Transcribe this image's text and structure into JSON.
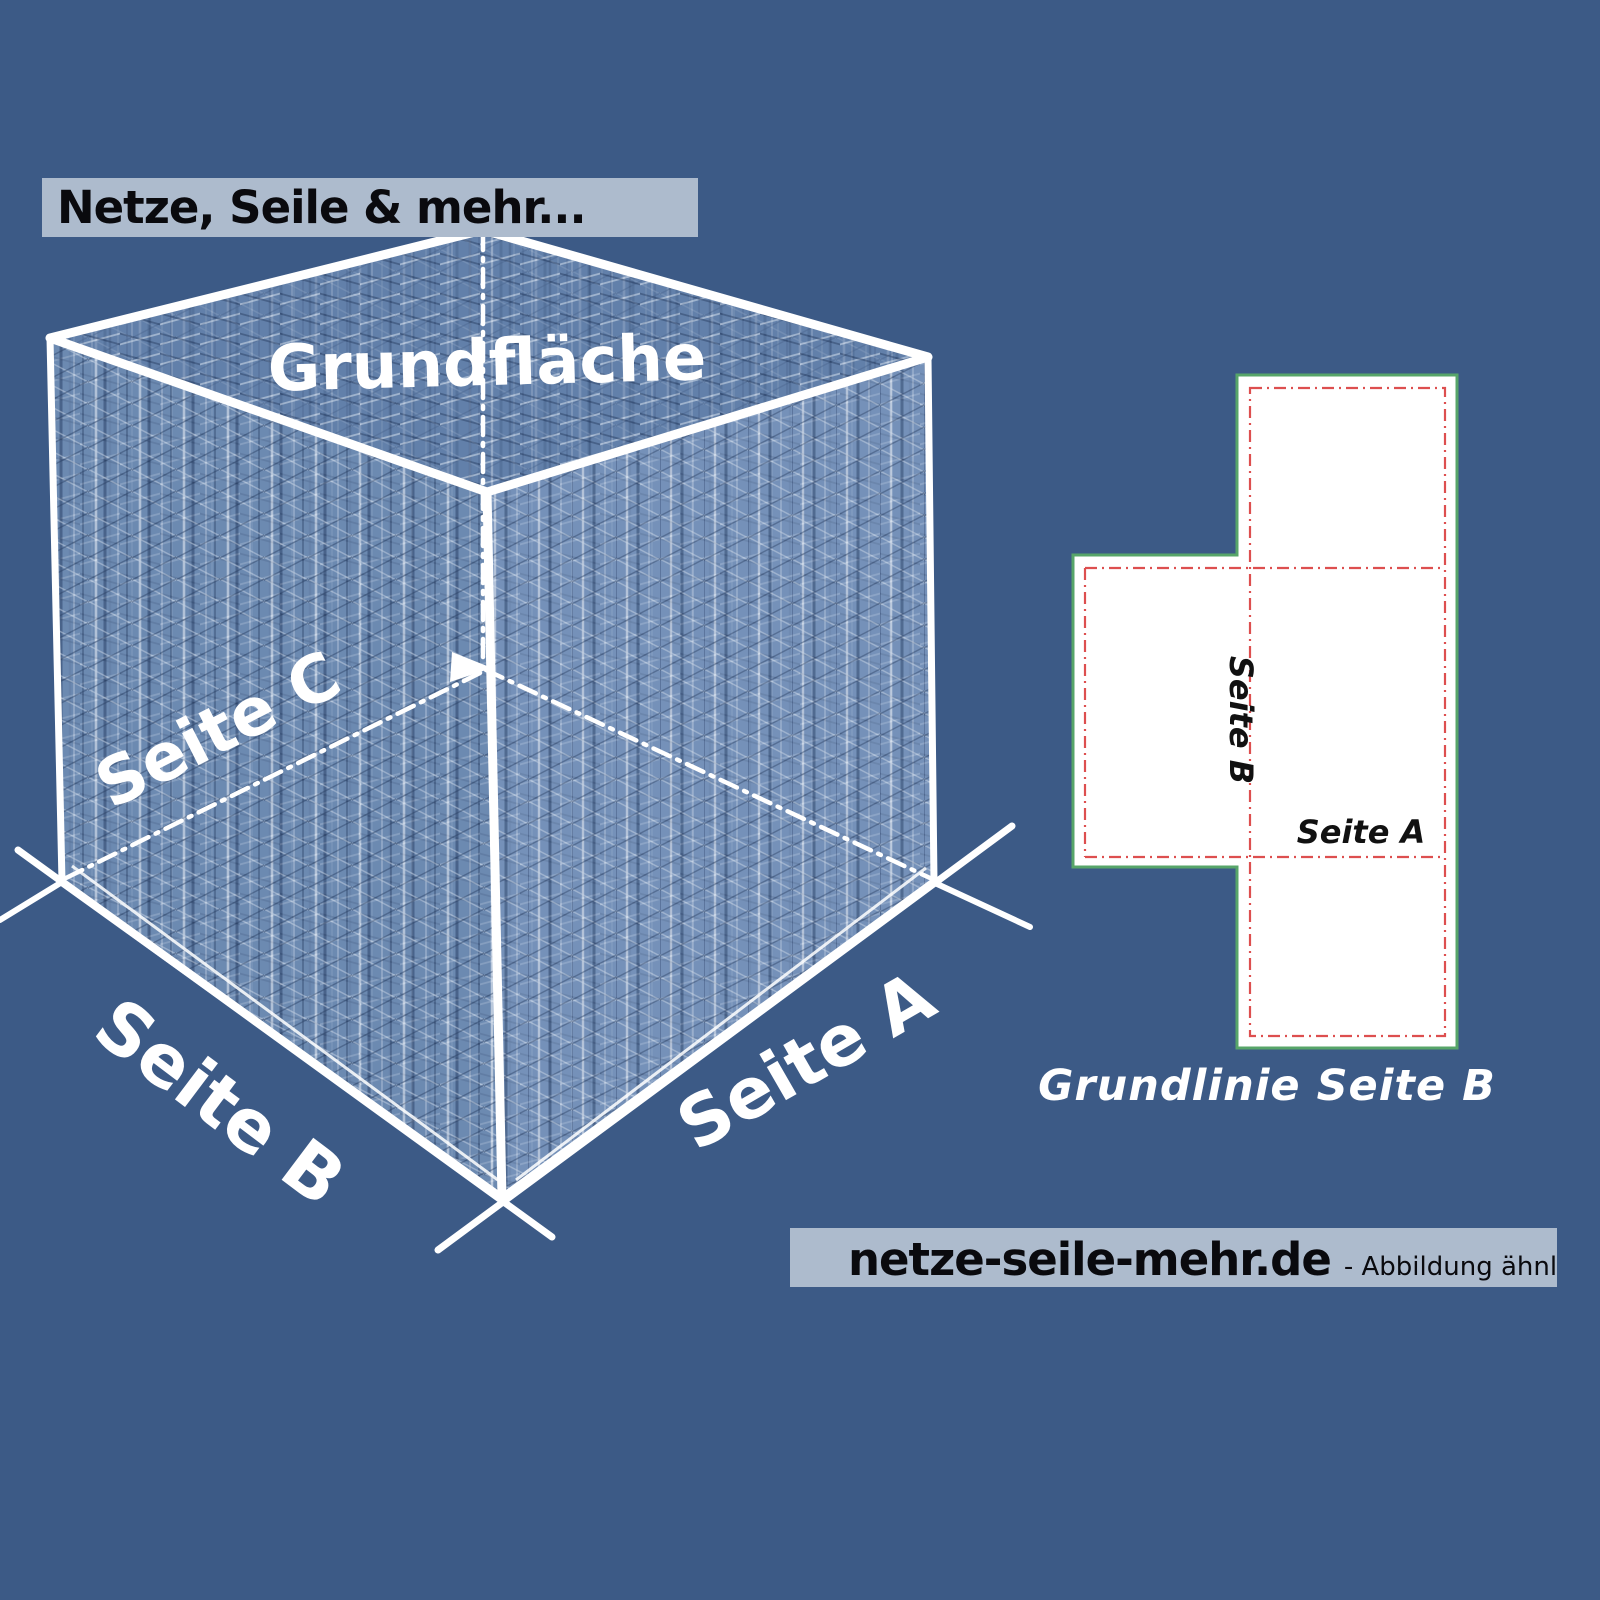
{
  "colors": {
    "background": "#3c5a86",
    "banner_bg": "#adbbcd",
    "banner_text": "#0a0a0e",
    "cube_lines": "#ffffff",
    "net_fill": "#ffffff",
    "net_outline_green": "#57a569",
    "net_fold_red": "#dd4f4f",
    "net_label_text": "#111111"
  },
  "header_banner": {
    "text": "Netze, Seile & mehr..."
  },
  "cube": {
    "top_face_label": "Grundfläche",
    "left_face_label": "Seite C",
    "bottom_left_edge_label": "Seite B",
    "bottom_right_edge_label": "Seite A"
  },
  "net_diagram": {
    "side_b_label": "Seite B",
    "side_a_label": "Seite A",
    "caption": "Grundlinie Seite B"
  },
  "footer_banner": {
    "site": "netze-seile-mehr.de",
    "note": "- Abbildung ähnlich"
  }
}
